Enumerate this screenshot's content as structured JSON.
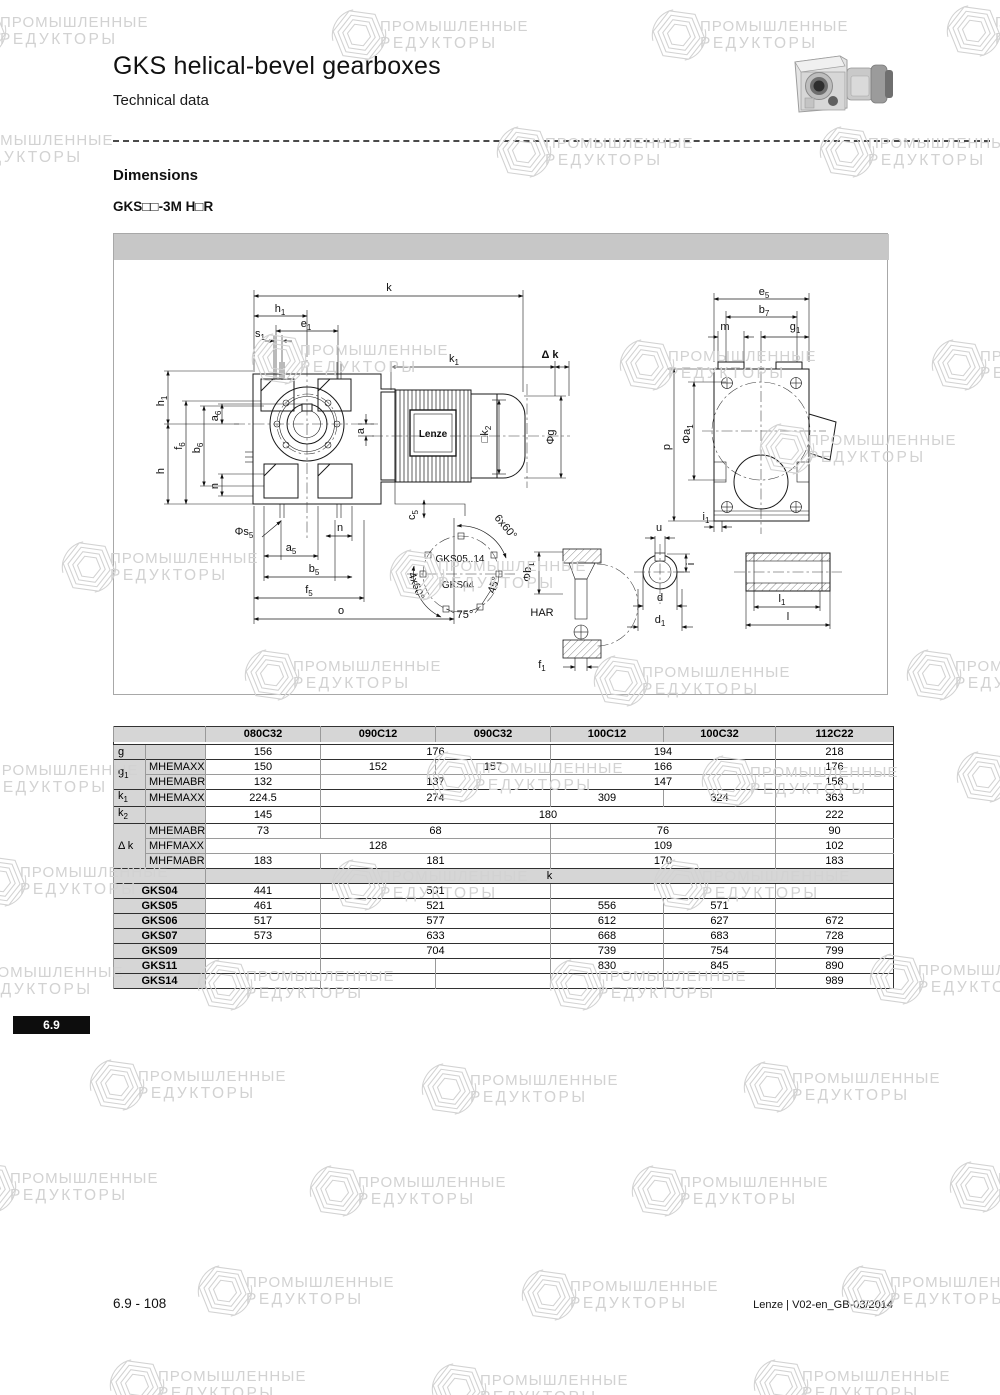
{
  "page": {
    "title": "GKS helical-bevel gearboxes",
    "subtitle": "Technical data",
    "section_heading": "Dimensions",
    "variant_label": "GKS□□-3M H□R",
    "tab_number": "6.9",
    "footer_left": "6.9 - 108",
    "footer_right": "Lenze | V02-en_GB-03/2014"
  },
  "watermark": {
    "line1": "ПРОМЫШЛЕННЫЕ",
    "line2": "РЕДУКТОРЫ",
    "color": "#d2d2d2",
    "positions": [
      {
        "x": -50,
        "y": 2
      },
      {
        "x": 330,
        "y": 6
      },
      {
        "x": 650,
        "y": 6
      },
      {
        "x": 945,
        "y": 2
      },
      {
        "x": -85,
        "y": 120
      },
      {
        "x": 495,
        "y": 123
      },
      {
        "x": 818,
        "y": 123
      },
      {
        "x": 250,
        "y": 330
      },
      {
        "x": 618,
        "y": 336
      },
      {
        "x": 930,
        "y": 336
      },
      {
        "x": 60,
        "y": 538
      },
      {
        "x": 388,
        "y": 546
      },
      {
        "x": 758,
        "y": 420
      },
      {
        "x": 243,
        "y": 646
      },
      {
        "x": 592,
        "y": 652
      },
      {
        "x": 905,
        "y": 646
      },
      {
        "x": -60,
        "y": 750
      },
      {
        "x": 425,
        "y": 748
      },
      {
        "x": 700,
        "y": 752
      },
      {
        "x": 955,
        "y": 748
      },
      {
        "x": -30,
        "y": 852
      },
      {
        "x": 330,
        "y": 856
      },
      {
        "x": 652,
        "y": 856
      },
      {
        "x": -75,
        "y": 952
      },
      {
        "x": 196,
        "y": 956
      },
      {
        "x": 548,
        "y": 956
      },
      {
        "x": 868,
        "y": 950
      },
      {
        "x": 88,
        "y": 1056
      },
      {
        "x": 420,
        "y": 1060
      },
      {
        "x": 742,
        "y": 1058
      },
      {
        "x": -40,
        "y": 1158
      },
      {
        "x": 308,
        "y": 1162
      },
      {
        "x": 630,
        "y": 1162
      },
      {
        "x": 948,
        "y": 1158
      },
      {
        "x": 196,
        "y": 1262
      },
      {
        "x": 520,
        "y": 1266
      },
      {
        "x": 840,
        "y": 1262
      },
      {
        "x": 108,
        "y": 1356
      },
      {
        "x": 430,
        "y": 1360
      },
      {
        "x": 752,
        "y": 1356
      }
    ]
  },
  "drawing": {
    "motor_label": "Lenze",
    "labels": [
      {
        "t": "k",
        "x": 275,
        "y": 57
      },
      {
        "t": "h_1",
        "x": 166,
        "y": 78
      },
      {
        "t": "e_1",
        "x": 192,
        "y": 93
      },
      {
        "t": "s_1",
        "x": 146,
        "y": 103
      },
      {
        "t": "k_1",
        "x": 340,
        "y": 128
      },
      {
        "t": "Δ k",
        "x": 436,
        "y": 124,
        "b": 1
      },
      {
        "t": "h_1",
        "x": 50,
        "y": 167,
        "r": -90
      },
      {
        "t": "f_6",
        "x": 68,
        "y": 212,
        "r": -90
      },
      {
        "t": "b_6",
        "x": 86,
        "y": 214,
        "r": -90
      },
      {
        "t": "a_6",
        "x": 104,
        "y": 182,
        "r": -90
      },
      {
        "t": "h",
        "x": 50,
        "y": 237,
        "r": -90
      },
      {
        "t": "n",
        "x": 104,
        "y": 252,
        "r": -90
      },
      {
        "t": "a",
        "x": 250,
        "y": 197,
        "r": -90
      },
      {
        "t": "□k_2",
        "x": 374,
        "y": 200,
        "r": -90
      },
      {
        "t": "Φg",
        "x": 440,
        "y": 203,
        "r": -90
      },
      {
        "t": "Lenze",
        "x": 319,
        "y": 203,
        "b": 1,
        "s": 10
      },
      {
        "t": "Φs_5",
        "x": 130,
        "y": 301
      },
      {
        "t": "n",
        "x": 226,
        "y": 297
      },
      {
        "t": "a_5",
        "x": 177,
        "y": 317
      },
      {
        "t": "b_5",
        "x": 200,
        "y": 338
      },
      {
        "t": "f_5",
        "x": 195,
        "y": 359
      },
      {
        "t": "o",
        "x": 227,
        "y": 380
      },
      {
        "t": "c_5",
        "x": 301,
        "y": 281,
        "r": -90
      },
      {
        "t": "GKS05..14",
        "x": 346,
        "y": 328,
        "s": 10
      },
      {
        "t": "GKS04",
        "x": 344,
        "y": 354,
        "s": 10
      },
      {
        "t": "6x60°",
        "x": 389,
        "y": 295,
        "r": 50
      },
      {
        "t": "4x60°",
        "x": 299,
        "y": 353,
        "r": 70
      },
      {
        "t": "45°",
        "x": 383,
        "y": 352,
        "r": -72
      },
      {
        "t": "75°",
        "x": 351,
        "y": 384
      },
      {
        "t": "HAR",
        "x": 428,
        "y": 382
      },
      {
        "t": "Φb_1",
        "x": 417,
        "y": 338,
        "r": -90
      },
      {
        "t": "f_1",
        "x": 428,
        "y": 434
      },
      {
        "t": "u",
        "x": 545,
        "y": 297
      },
      {
        "t": "i",
        "x": 580,
        "y": 330,
        "r": -90
      },
      {
        "t": "d",
        "x": 546,
        "y": 367
      },
      {
        "t": "d_1",
        "x": 546,
        "y": 389
      },
      {
        "t": "l_1",
        "x": 668,
        "y": 368
      },
      {
        "t": "l",
        "x": 674,
        "y": 386
      },
      {
        "t": "e_5",
        "x": 650,
        "y": 61
      },
      {
        "t": "b_7",
        "x": 650,
        "y": 79
      },
      {
        "t": "m",
        "x": 611,
        "y": 96
      },
      {
        "t": "g_1",
        "x": 681,
        "y": 96
      },
      {
        "t": "p",
        "x": 556,
        "y": 213,
        "r": -90
      },
      {
        "t": "Φa_1",
        "x": 576,
        "y": 200,
        "r": -90
      },
      {
        "t": "i_1",
        "x": 592,
        "y": 286
      }
    ]
  },
  "table": {
    "columns": [
      "080C32",
      "090C12",
      "090C32",
      "100C12",
      "100C32",
      "112C22"
    ],
    "rows": [
      {
        "label": "g",
        "rowspan": 1,
        "sub": "",
        "gs": 1,
        "cells": [
          [
            "156",
            1
          ],
          [
            "176",
            2
          ],
          [
            "194",
            2
          ],
          [
            "218",
            1
          ]
        ]
      },
      {
        "label": "g_1",
        "rowspan": 2,
        "sub": "MHEMAXX",
        "gs": 1,
        "cells": [
          [
            "150",
            1
          ],
          [
            "152",
            1
          ],
          [
            "157",
            1
          ],
          [
            "166",
            2
          ],
          [
            "176",
            1
          ]
        ]
      },
      {
        "sub": "MHEMABR",
        "cells": [
          [
            "132",
            1
          ],
          [
            "137",
            2
          ],
          [
            "147",
            2
          ],
          [
            "158",
            1
          ]
        ]
      },
      {
        "label": "k_1",
        "rowspan": 1,
        "sub": "MHEMAXX",
        "gs": 1,
        "cells": [
          [
            "224.5",
            1
          ],
          [
            "274",
            2
          ],
          [
            "309",
            1
          ],
          [
            "324",
            1
          ],
          [
            "363",
            1
          ]
        ]
      },
      {
        "label": "k_2",
        "rowspan": 1,
        "sub": "",
        "gs": 1,
        "cells": [
          [
            "145",
            1
          ],
          [
            "180",
            4
          ],
          [
            "222",
            1
          ]
        ]
      },
      {
        "label": "Δ k",
        "rowspan": 3,
        "sub": "MHEMABR",
        "gs": 1,
        "cells": [
          [
            "73",
            1
          ],
          [
            "68",
            2
          ],
          [
            "76",
            2
          ],
          [
            "90",
            1
          ]
        ]
      },
      {
        "sub": "MHFMAXX",
        "cells": [
          [
            "128",
            3
          ],
          [
            "109",
            2
          ],
          [
            "102",
            1
          ]
        ]
      },
      {
        "sub": "MHFMABR",
        "cells": [
          [
            "183",
            1
          ],
          [
            "181",
            2
          ],
          [
            "170",
            2
          ],
          [
            "183",
            1
          ]
        ]
      }
    ],
    "k_section_label": "k",
    "k_rows": [
      {
        "label": "GKS04",
        "cells": [
          [
            "441",
            1
          ],
          [
            "501",
            2
          ],
          [
            "",
            2
          ],
          [
            "",
            1
          ]
        ]
      },
      {
        "label": "GKS05",
        "cells": [
          [
            "461",
            1
          ],
          [
            "521",
            2
          ],
          [
            "556",
            1
          ],
          [
            "571",
            1
          ],
          [
            "",
            1
          ]
        ]
      },
      {
        "label": "GKS06",
        "cells": [
          [
            "517",
            1
          ],
          [
            "577",
            2
          ],
          [
            "612",
            1
          ],
          [
            "627",
            1
          ],
          [
            "672",
            1
          ]
        ]
      },
      {
        "label": "GKS07",
        "cells": [
          [
            "573",
            1
          ],
          [
            "633",
            2
          ],
          [
            "668",
            1
          ],
          [
            "683",
            1
          ],
          [
            "728",
            1
          ]
        ]
      },
      {
        "label": "GKS09",
        "cells": [
          [
            "",
            1
          ],
          [
            "704",
            2
          ],
          [
            "739",
            1
          ],
          [
            "754",
            1
          ],
          [
            "799",
            1
          ]
        ]
      },
      {
        "label": "GKS11",
        "cells": [
          [
            "",
            1
          ],
          [
            "",
            1
          ],
          [
            "",
            1
          ],
          [
            "830",
            1
          ],
          [
            "845",
            1
          ],
          [
            "890",
            1
          ]
        ]
      },
      {
        "label": "GKS14",
        "cells": [
          [
            "",
            1
          ],
          [
            "",
            1
          ],
          [
            "",
            1
          ],
          [
            "",
            1
          ],
          [
            "",
            1
          ],
          [
            "989",
            1
          ]
        ]
      }
    ]
  }
}
